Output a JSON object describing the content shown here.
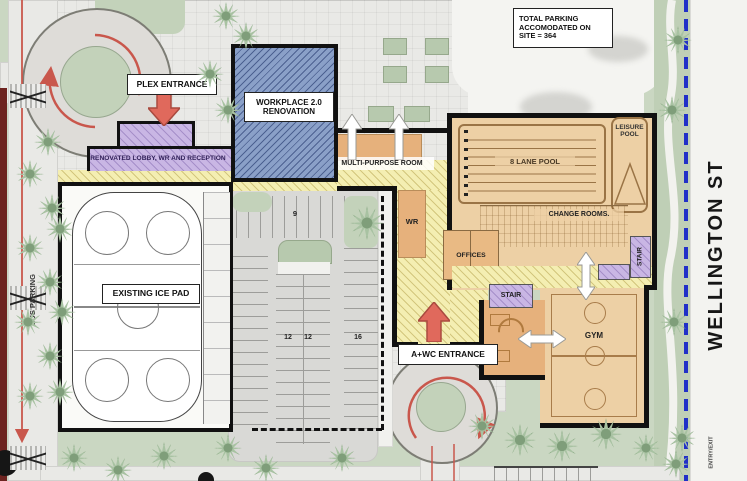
{
  "labels": {
    "total_parking": "TOTAL PARKING ACCOMODATED ON SITE = 364",
    "plex_entrance": "PLEX ENTRANCE",
    "workplace": "WORKPLACE 2.0 RENOVATION",
    "lobby": "RENOVATED LOBBY, WR AND RECEPTION",
    "multi_purpose": "MULTI-PURPOSE ROOM",
    "lane_pool": "8 LANE POOL",
    "leisure_pool": "LEISURE POOL",
    "change_rooms": "CHANGE ROOMS.",
    "wr": "WR",
    "offices": "OFFICES",
    "stair": "STAIR",
    "ice_pad": "EXISTING ICE PAD",
    "gym": "GYM",
    "awc_entrance": "A+WC ENTRANCE",
    "bus_parking": "BUS PARKING",
    "wellington": "WELLINGTON ST",
    "entry_exit": "ENTRY/EXIT"
  },
  "parking_counts": {
    "row_north": "9",
    "bay_left": "12",
    "bay_right": "12",
    "bay_east": "16"
  },
  "colors": {
    "landscape_green": "#cad7c2",
    "building_tan": "#edd0a5",
    "room_orange": "#e6b17c",
    "corridor_yellow": "#f4eeb2",
    "stair_purple": "#c9b6e4",
    "workplace_blue": "#8aa0c8",
    "entrance_arrow_red": "#e0695c",
    "road_line_red": "#c9574c",
    "property_line_blue": "#2030c8"
  }
}
